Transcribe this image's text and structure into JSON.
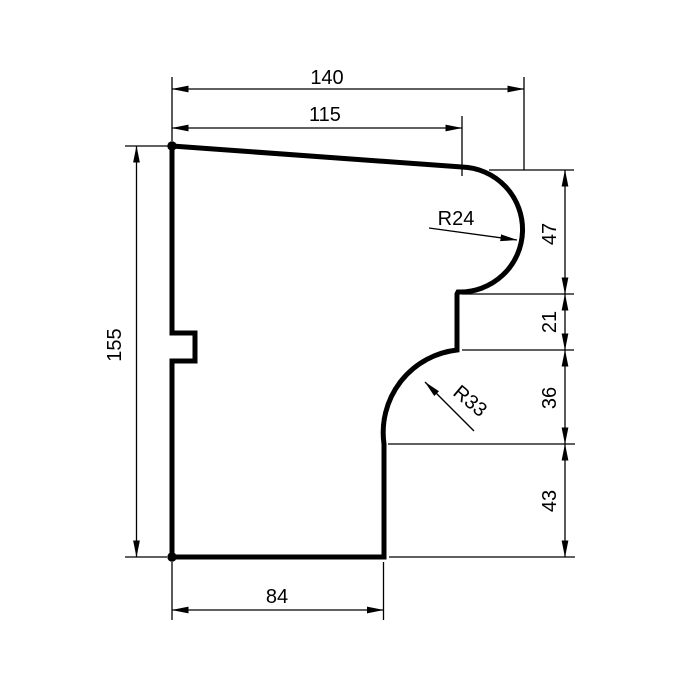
{
  "drawing": {
    "type": "technical-profile-cross-section",
    "background_color": "#ffffff",
    "line_color": "#000000",
    "dimensions": {
      "total_width": "140",
      "upper_width": "115",
      "total_height": "155",
      "bottom_width": "84",
      "bullnose_section_height": "47",
      "step_section_height": "21",
      "cove_section_height": "36",
      "base_section_height": "43"
    },
    "radii": {
      "bullnose": "R24",
      "cove": "R33"
    }
  }
}
